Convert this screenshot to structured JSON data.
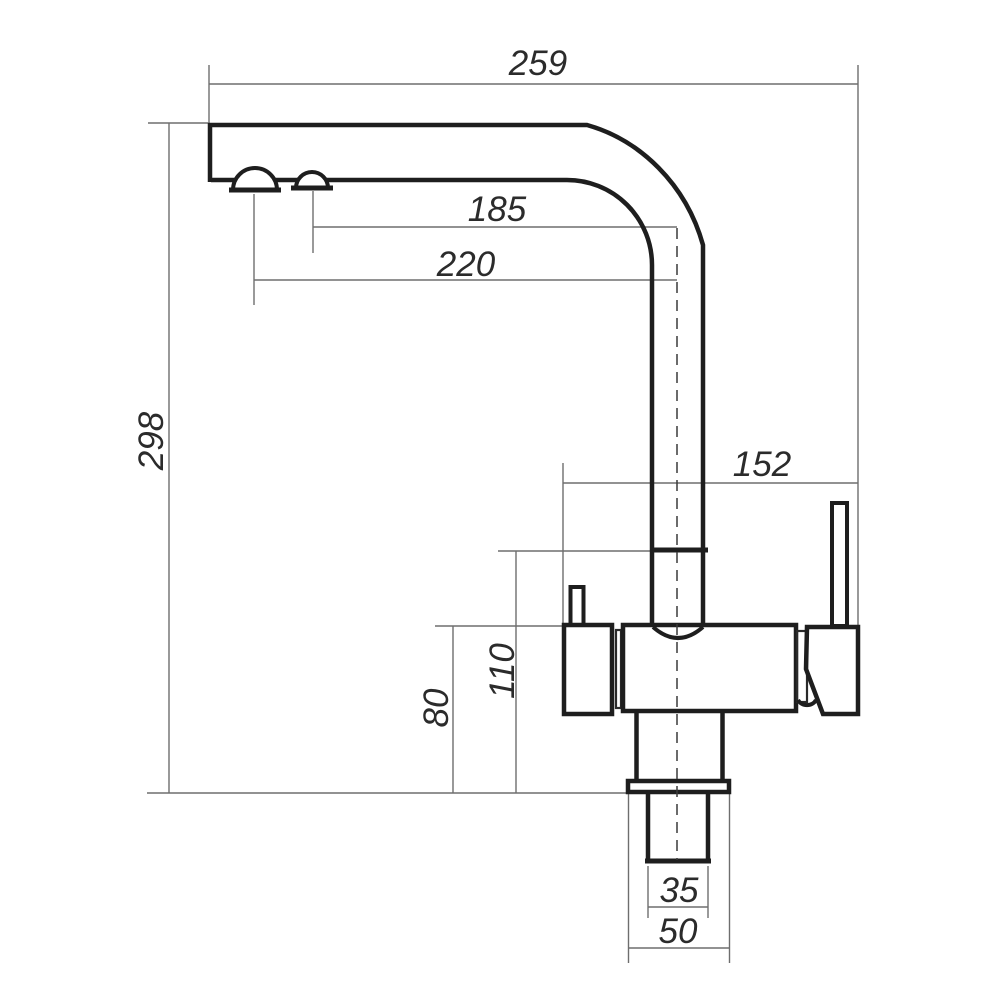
{
  "drawing": {
    "type": "technical-dimension-drawing",
    "subject": "kitchen-faucet-side-view",
    "units_shown": "",
    "dimensions": [
      {
        "name": "spout-reach",
        "value": "259",
        "orientation": "horizontal"
      },
      {
        "name": "outlet-2-offset",
        "value": "185",
        "orientation": "horizontal"
      },
      {
        "name": "outlet-1-offset",
        "value": "220",
        "orientation": "horizontal"
      },
      {
        "name": "total-height",
        "value": "298",
        "orientation": "vertical"
      },
      {
        "name": "body-span",
        "value": "152",
        "orientation": "horizontal"
      },
      {
        "name": "joint-height",
        "value": "110",
        "orientation": "vertical"
      },
      {
        "name": "body-height",
        "value": "80",
        "orientation": "vertical"
      },
      {
        "name": "shank-width",
        "value": "35",
        "orientation": "horizontal"
      },
      {
        "name": "base-width",
        "value": "50",
        "orientation": "horizontal"
      }
    ],
    "colors": {
      "background": "#ffffff",
      "outline": "#1e1e1e",
      "dimension_lines": "#6e6e6e",
      "centerline": "#3a3a3a",
      "label_text": "#2b2b2b"
    }
  }
}
